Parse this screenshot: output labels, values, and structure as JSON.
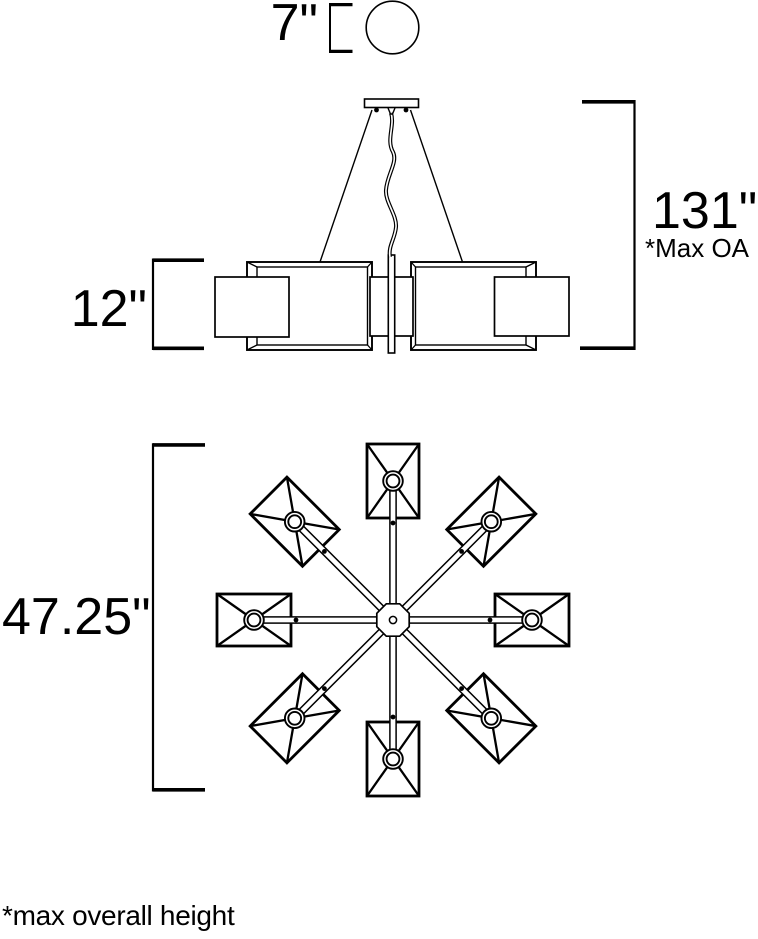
{
  "page": {
    "background_color": "#ffffff",
    "line_color": "#000000"
  },
  "dimensions": {
    "canopy_diameter": "7\"",
    "max_overall_height": "131\"",
    "max_overall_height_note": "*Max OA",
    "shade_height": "12\"",
    "fixture_width": "47.25\"",
    "footnote": "*max overall height"
  }
}
